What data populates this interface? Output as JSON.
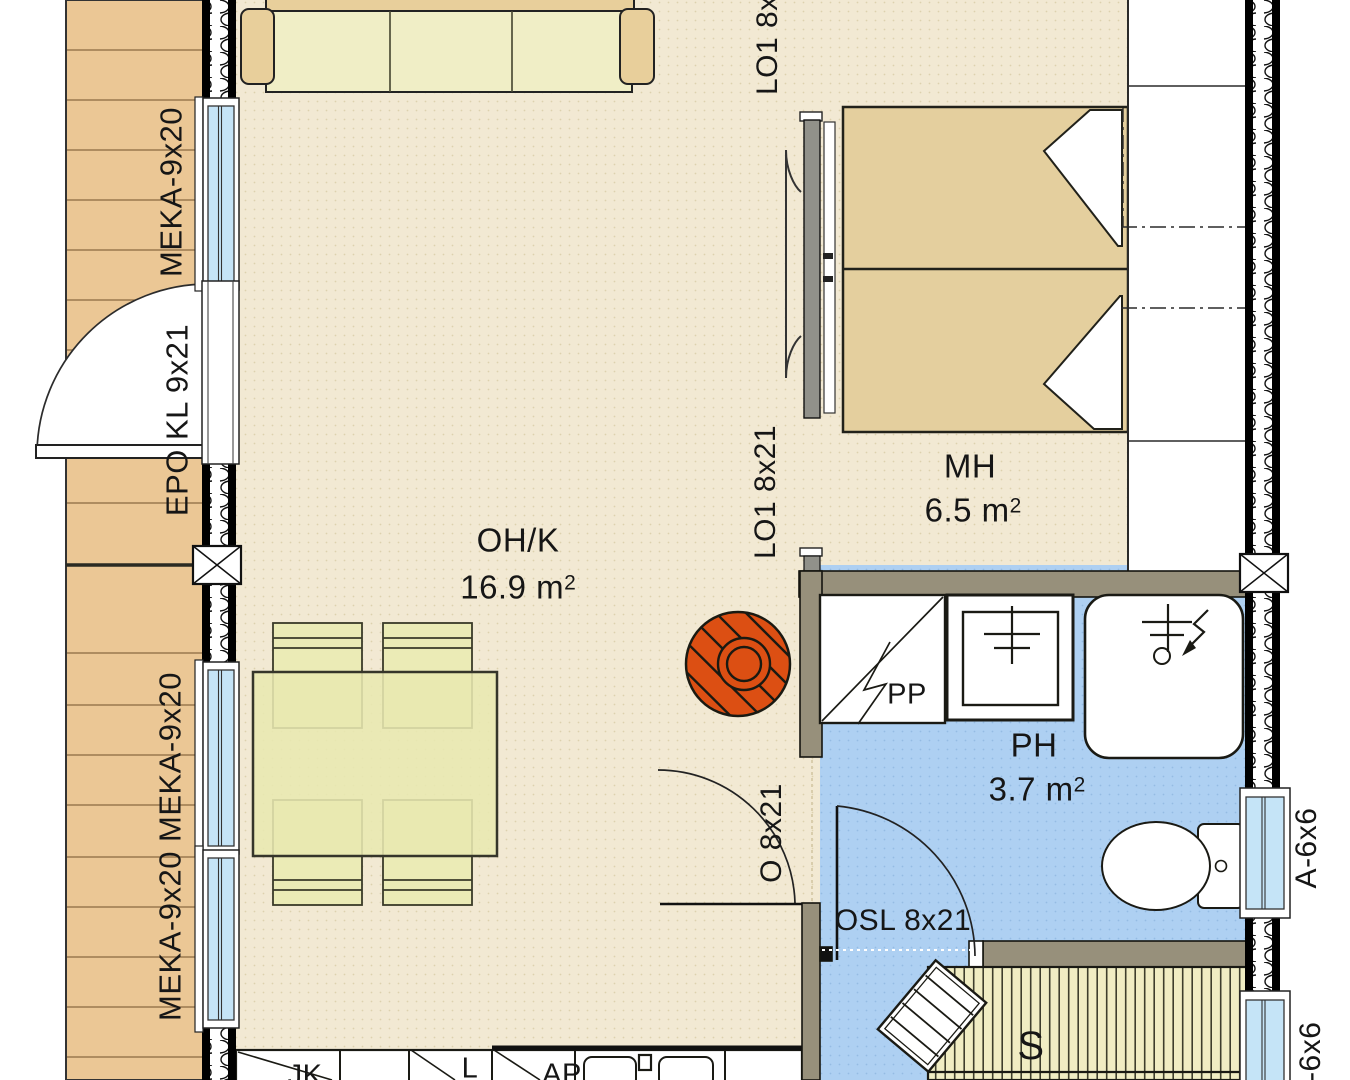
{
  "rooms": {
    "living": {
      "name": "OH/K",
      "area": "16.9 m",
      "sup": "2"
    },
    "bedroom": {
      "name": "MH",
      "area": "6.5 m",
      "sup": "2"
    },
    "bathroom": {
      "name": "PH",
      "area": "3.7 m",
      "sup": "2"
    },
    "sauna": {
      "name": "S"
    }
  },
  "openings": {
    "window_meka_top": "MEKA-9x20",
    "entry_door": "EPO KL 9x21",
    "window_meka_mid": "MEKA-9x20",
    "window_meka_bottom": "MEKA-9x20",
    "slider_label_top": "LO1 8x21",
    "slider_label_bottom": "LO1 8x21",
    "bath_door": "O 8x21",
    "sauna_door": "OSL 8x21",
    "window_bath": "A-6x6",
    "window_sauna": "A-6x6"
  },
  "appliances": {
    "washer": "PP",
    "fridge": "JK",
    "stove": "L",
    "dishwasher": "AP"
  },
  "colors": {
    "floor_dry": "#f2e9d3",
    "floor_wet": "#aed0f2",
    "deck_wood": "#ebc795",
    "bench_wood": "#f0edc3",
    "bed_fabric": "#e4cf9e",
    "fireplace_accent": "#dc4f13",
    "wall_interior": "#97907b",
    "glazing": "#c5e4f7"
  }
}
